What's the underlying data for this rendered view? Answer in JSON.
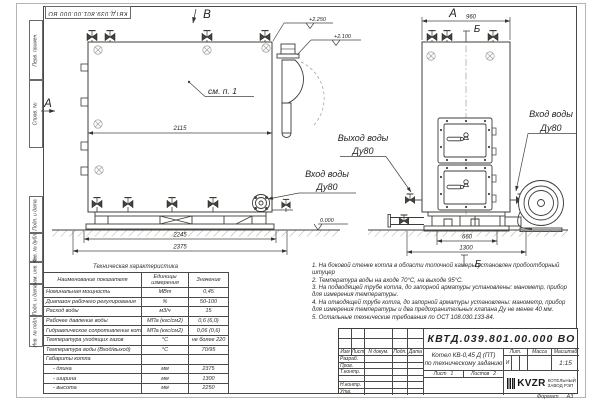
{
  "stamp_top": "КВТД.039.801.00.000 ВО",
  "frame_labels": {
    "perv_primen": "Перв. примен.",
    "sprav_n": "Справ. №",
    "podp_data1": "Подп. и дата",
    "inv_dubl": "Инв. № дубл.",
    "vzam_inv": "Взам. инв. №",
    "podp_data2": "Подп. и дата",
    "inv_podl": "Инв. № подл."
  },
  "views": {
    "view_b_label": "В",
    "view_a_side_label": "А",
    "view_a_front_label": "А",
    "section_b_top": "Б",
    "section_b_bottom": "Б",
    "callout_see": "см. п. 1",
    "outlet_line1": "Выход воды",
    "outlet_line2": "Ду80",
    "inlet_front_line1": "Вход воды",
    "inlet_front_line2": "Ду80",
    "inlet_side_line1": "Вход воды",
    "inlet_side_line2": "Ду80"
  },
  "dimensions": {
    "side_top": "2115",
    "side_mid": "2245",
    "side_bottom": "2375",
    "front_top": "960",
    "front_mid": "660",
    "front_bottom": "1300"
  },
  "elevations": {
    "top": "+2.250",
    "mid": "+2.100",
    "ground": "0.000"
  },
  "tech_table": {
    "title": "Техническая характеристика",
    "headers": [
      "Наименование показателя",
      "Единицы измерения",
      "Значение"
    ],
    "rows": [
      {
        "name": "Номинальная мощность",
        "unit": "МВт",
        "value": "0,45"
      },
      {
        "name": "Диапазон рабочего регулирования",
        "unit": "%",
        "value": "50-100"
      },
      {
        "name": "Расход воды",
        "unit": "м3/ч",
        "value": "15"
      },
      {
        "name": "Рабочее давление воды",
        "unit": "МПа (кгс/см2)",
        "value": "0,6 (6,0)"
      },
      {
        "name": "Гидравлическое сопротивление котла",
        "unit": "МПа (кгс/см2)",
        "value": "0,06 (0,6)"
      },
      {
        "name": "Температура уходящих газов",
        "unit": "°С",
        "value": "не более 220"
      },
      {
        "name": "Температура воды (Вход/выход)",
        "unit": "°С",
        "value": "70/95"
      },
      {
        "name": "Габариты котла",
        "unit": "",
        "value": ""
      },
      {
        "name": "- длина",
        "unit": "мм",
        "value": "2375"
      },
      {
        "name": "- ширина",
        "unit": "мм",
        "value": "1300"
      },
      {
        "name": "- высота",
        "unit": "мм",
        "value": "2250"
      }
    ]
  },
  "notes": [
    "1.  На боковой стенке котла в области топочной камеры установлен пробоотборный штуцер",
    "2.  Температура воды на входе 70°С, на выходе 95°С.",
    "3.  На подводящей трубе котла, до запорной арматуры установлены: манометр, прибор для измерения температуры.",
    "4.  На отводящей трубе котла, до запорной арматуры установлены: манометр, прибор для измерения температуры и два предохранительных клапана Ду не менее 40 мм.",
    "5.  Остальные технические требования по ОСТ 108.030.133-84."
  ],
  "title_block": {
    "designation": "КВТД.039.801.00.000 ВО",
    "doc_name_line1": "Котел КВ-0,45 Д (ПТ)",
    "doc_name_line2": "по техническому заданию",
    "rev_headers": {
      "izm": "Изм",
      "list": "Лист",
      "n_dokum": "N докум.",
      "podp": "Подп.",
      "data": "Дата"
    },
    "sign_rows": [
      "Разраб.",
      "Пров.",
      "Т.контр.",
      "",
      "Н.контр.",
      "Утв."
    ],
    "lit_header": "Лит.",
    "massa_header": "Масса",
    "masshtab_header": "Масштаб",
    "lit_value": "И",
    "scale_value": "1:15",
    "sheet_label": "Лист",
    "sheet_value": "1",
    "sheets_label": "Листов",
    "sheets_value": "2",
    "company_logo": "KVZR",
    "company_line1": "КОТЕЛЬНЫЙ",
    "company_line2": "ЗАВОД РЭП",
    "format_label": "Формат",
    "format_value": "А3"
  }
}
